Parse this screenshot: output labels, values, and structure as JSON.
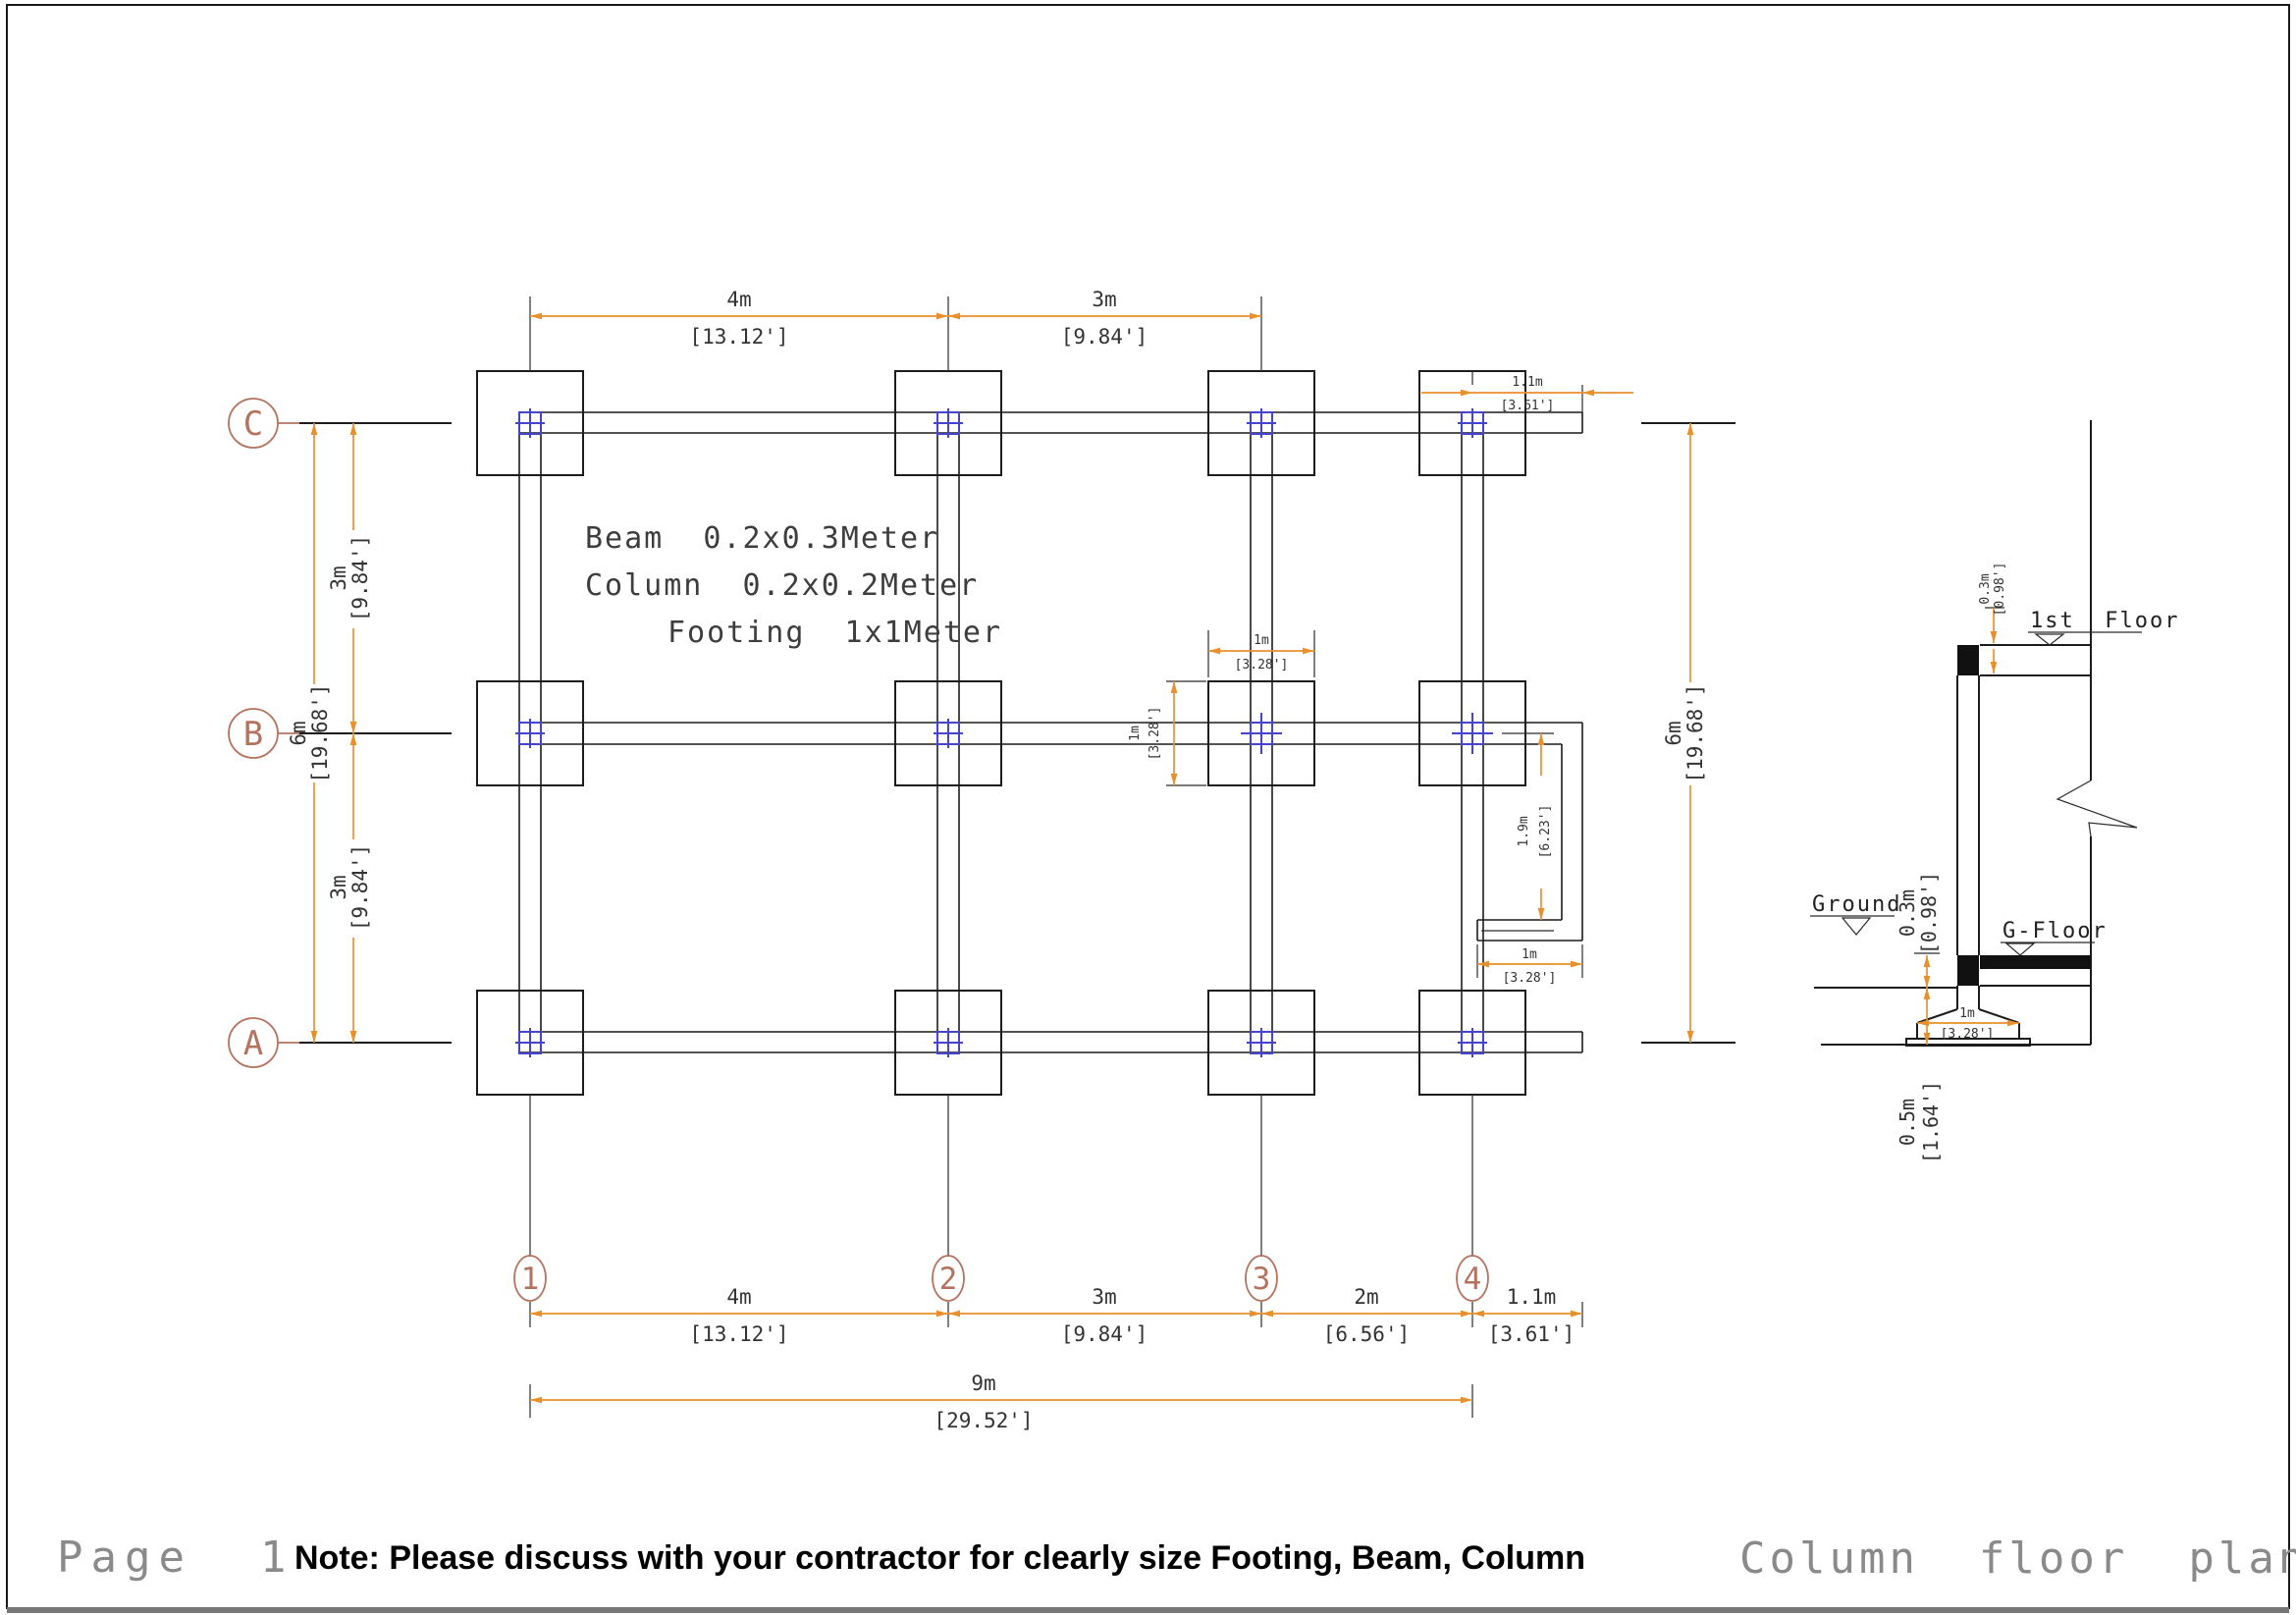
{
  "page": {
    "label": "Page  1",
    "note": "Note: Please discuss with your contractor for clearly size Footing, Beam, Column",
    "title": "Column  floor  plan"
  },
  "specs": {
    "beam": "Beam  0.2x0.3Meter",
    "column": "Column  0.2x0.2Meter",
    "footing": "Footing  1x1Meter"
  },
  "grid": {
    "cols": [
      "1",
      "2",
      "3",
      "4"
    ],
    "rows": [
      "C",
      "B",
      "A"
    ]
  },
  "dims": {
    "top_span1": {
      "m": "4m",
      "ft": "[13.12']"
    },
    "top_span2": {
      "m": "3m",
      "ft": "[9.84']"
    },
    "top_right": {
      "m": "1.1m",
      "ft": "[3.61']"
    },
    "left_cb": {
      "m": "3m",
      "ft": "[9.84']"
    },
    "left_total": {
      "m": "6m",
      "ft": "[19.68']"
    },
    "left_ba": {
      "m": "3m",
      "ft": "[9.84']"
    },
    "right_total": {
      "m": "6m",
      "ft": "[19.68']"
    },
    "footing_w": {
      "m": "1m",
      "ft": "[3.28']"
    },
    "footing_h": {
      "m": "1m",
      "ft": "[3.28']"
    },
    "stair_h": {
      "m": "1.9m",
      "ft": "[6.23']"
    },
    "stair_w": {
      "m": "1m",
      "ft": "[3.28']"
    },
    "bot_span1": {
      "m": "4m",
      "ft": "[13.12']"
    },
    "bot_span2": {
      "m": "3m",
      "ft": "[9.84']"
    },
    "bot_span3": {
      "m": "2m",
      "ft": "[6.56']"
    },
    "bot_span4": {
      "m": "1.1m",
      "ft": "[3.61']"
    },
    "bot_total": {
      "m": "9m",
      "ft": "[29.52']"
    },
    "sec_beam_top": {
      "m": "0.3m",
      "ft": "[0.98']"
    },
    "sec_beam_g": {
      "m": "0.3m",
      "ft": "[0.98']"
    },
    "sec_footing_depth": {
      "m": "0.5m",
      "ft": "[1.64']"
    },
    "sec_footing_w": {
      "m": "1m",
      "ft": "[3.28']"
    }
  },
  "section": {
    "first_floor": "1st  Floor",
    "g_floor": "G-Floor",
    "ground": "Ground"
  },
  "colors": {
    "dimension": "#E8912C",
    "grid_bubble": "#B5735F",
    "column_marker": "#4444CC",
    "line": "#1C1C1C"
  }
}
